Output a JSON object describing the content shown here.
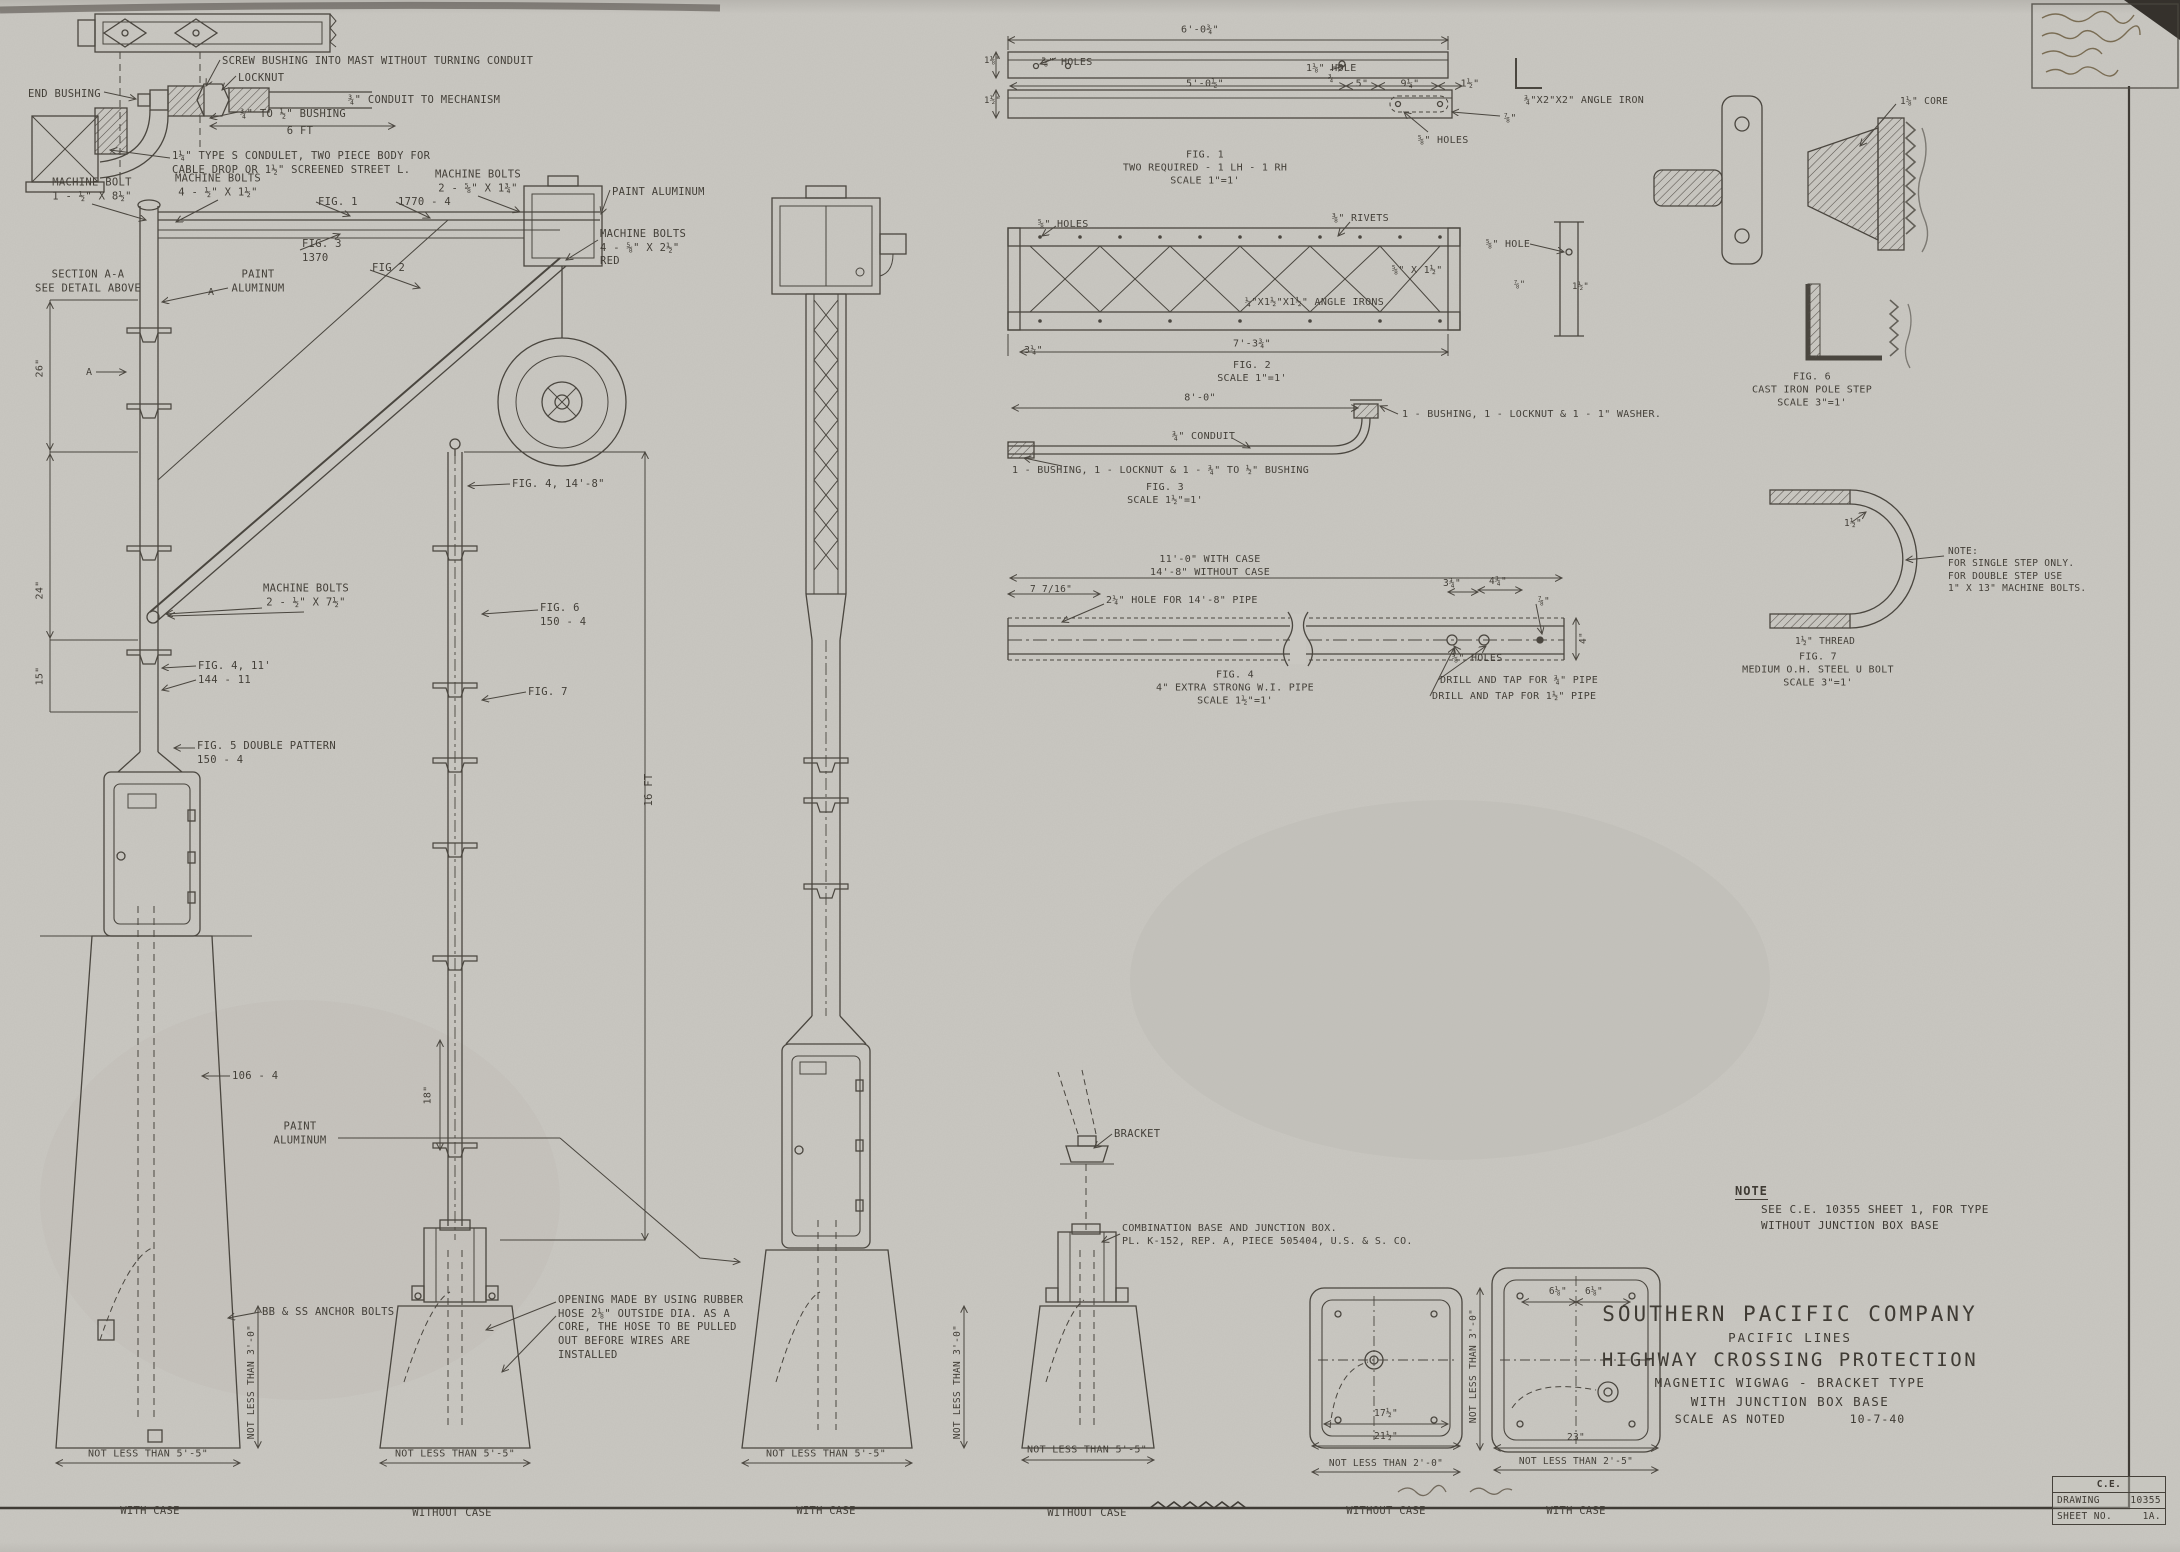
{
  "colors": {
    "paper": "#c9c7c1",
    "ink": "#4a463f"
  },
  "title_block": {
    "company": "SOUTHERN PACIFIC COMPANY",
    "division": "PACIFIC LINES",
    "title": "HIGHWAY CROSSING PROTECTION",
    "subtitle": "MAGNETIC WIGWAG - BRACKET TYPE",
    "base_type": "WITH JUNCTION BOX BASE",
    "scale": "SCALE AS NOTED",
    "date": "10-7-40"
  },
  "doc_box": {
    "org": "C.E.",
    "drawing_label": "DRAWING",
    "drawing_number": "10355",
    "sheet_label": "SHEET NO.",
    "sheet_number": "1A."
  },
  "note": {
    "heading": "NOTE",
    "line1": "SEE C.E. 10355 SHEET 1, FOR TYPE",
    "line2": "WITHOUT JUNCTION BOX BASE"
  },
  "labels": [
    {
      "name": "label-screw-bushing",
      "text": "SCREW BUSHING INTO MAST WITHOUT TURNING CONDUIT",
      "x": 222,
      "y": 55
    },
    {
      "name": "label-end-bushing",
      "text": "END BUSHING",
      "x": 28,
      "y": 88
    },
    {
      "name": "label-locknut",
      "text": "LOCKNUT",
      "x": 238,
      "y": 72
    },
    {
      "name": "label-conduit-to-mechanism",
      "text": "¾\" CONDUIT TO MECHANISM",
      "x": 348,
      "y": 94
    },
    {
      "name": "label-bushing-size",
      "text": "¾\" TO ½\" BUSHING",
      "x": 240,
      "y": 108
    },
    {
      "name": "label-dim-6ft",
      "text": "6 FT",
      "x": 300,
      "y": 132,
      "align": "center"
    },
    {
      "name": "label-condulet",
      "text": "1¼\" TYPE S CONDULET, TWO PIECE BODY FOR\nCABLE DROP OR 1½\" SCREENED STREET L.",
      "x": 172,
      "y": 150
    },
    {
      "name": "label-machine-bolt-8",
      "text": "MACHINE BOLT\n1 - ½\" X 8½\"",
      "x": 92,
      "y": 190,
      "align": "center"
    },
    {
      "name": "label-machine-bolts-4",
      "text": "MACHINE BOLTS\n4 - ½\" X 1½\"",
      "x": 218,
      "y": 186,
      "align": "center"
    },
    {
      "name": "label-machine-bolts-2",
      "text": "MACHINE BOLTS\n2 - ⅝\" X 1¾\"",
      "x": 478,
      "y": 182,
      "align": "center"
    },
    {
      "name": "label-paint-aluminum-arm",
      "text": "PAINT ALUMINUM",
      "x": 612,
      "y": 186
    },
    {
      "name": "label-fig1-ref",
      "text": "FIG. 1",
      "x": 318,
      "y": 196
    },
    {
      "name": "label-1770-4",
      "text": "1770 - 4",
      "x": 398,
      "y": 196
    },
    {
      "name": "label-machine-bolts-red",
      "text": "MACHINE BOLTS\n4 - ⅝\" X 2½\"\nRED",
      "x": 600,
      "y": 228
    },
    {
      "name": "label-fig3-ref",
      "text": "FIG. 3\n1370",
      "x": 302,
      "y": 238
    },
    {
      "name": "label-fig2-ref",
      "text": "FIG 2",
      "x": 372,
      "y": 262
    },
    {
      "name": "label-section-aa",
      "text": "SECTION A-A\nSEE DETAIL ABOVE",
      "x": 88,
      "y": 282,
      "align": "center"
    },
    {
      "name": "label-a-marker-1",
      "text": "A",
      "x": 86,
      "y": 366,
      "size": 10
    },
    {
      "name": "label-a-marker-2",
      "text": "A",
      "x": 208,
      "y": 286,
      "size": 10
    },
    {
      "name": "label-paint-aluminum-mast",
      "text": "PAINT\nALUMINUM",
      "x": 258,
      "y": 282,
      "align": "center"
    },
    {
      "name": "label-dim-26",
      "text": "26\"",
      "x": 40,
      "y": 368,
      "size": 10,
      "align": "center",
      "rot": -90
    },
    {
      "name": "label-dim-24",
      "text": "24\"",
      "x": 40,
      "y": 590,
      "size": 10,
      "align": "center",
      "rot": -90
    },
    {
      "name": "label-dim-15",
      "text": "15\"",
      "x": 40,
      "y": 676,
      "size": 10,
      "align": "center",
      "rot": -90
    },
    {
      "name": "label-machine-bolts-7",
      "text": "MACHINE BOLTS\n2 - ½\" X 7½\"",
      "x": 306,
      "y": 596,
      "align": "center"
    },
    {
      "name": "label-fig4-11",
      "text": "FIG. 4, 11'\n144 - 11",
      "x": 198,
      "y": 660
    },
    {
      "name": "label-fig4-148",
      "text": "FIG. 4, 14'-8\"",
      "x": 512,
      "y": 478
    },
    {
      "name": "label-fig5-double",
      "text": "FIG. 5 DOUBLE PATTERN\n150 - 4",
      "x": 197,
      "y": 740
    },
    {
      "name": "label-fig6-ref",
      "text": "FIG. 6\n150 - 4",
      "x": 540,
      "y": 602
    },
    {
      "name": "label-fig7-ref",
      "text": "FIG. 7",
      "x": 528,
      "y": 686
    },
    {
      "name": "label-dim-16ft",
      "text": "16 FT",
      "x": 650,
      "y": 790,
      "align": "center",
      "rot": -90
    },
    {
      "name": "label-106-4",
      "text": "106 - 4",
      "x": 232,
      "y": 1070
    },
    {
      "name": "label-paint-aluminum-case",
      "text": "PAINT\nALUMINUM",
      "x": 300,
      "y": 1134,
      "align": "center"
    },
    {
      "name": "label-dim-18",
      "text": "18\"",
      "x": 428,
      "y": 1095,
      "size": 10,
      "align": "center",
      "rot": -90
    },
    {
      "name": "label-anchor-bolts",
      "text": "BB & SS ANCHOR BOLTS",
      "x": 262,
      "y": 1306
    },
    {
      "name": "label-hose-note",
      "text": "OPENING MADE BY USING RUBBER\nHOSE 2⅛\" OUTSIDE DIA. AS A\nCORE, THE HOSE TO BE PULLED\nOUT BEFORE WIRES ARE\nINSTALLED",
      "x": 558,
      "y": 1294
    },
    {
      "name": "label-bracket",
      "text": "BRACKET",
      "x": 1114,
      "y": 1128
    },
    {
      "name": "label-combination-base",
      "text": "COMBINATION BASE AND JUNCTION BOX.\nPL. K-152, REP. A, PIECE 505404, U.S. & S. CO.",
      "x": 1122,
      "y": 1222,
      "size": 10
    },
    {
      "name": "label-nlt-1",
      "text": "NOT LESS THAN 5'-5\"",
      "x": 148,
      "y": 1454,
      "size": 10,
      "align": "center"
    },
    {
      "name": "label-nlt-2",
      "text": "NOT LESS THAN 5'-5\"",
      "x": 455,
      "y": 1454,
      "size": 10,
      "align": "center"
    },
    {
      "name": "label-nlt-3",
      "text": "NOT LESS THAN 5'-5\"",
      "x": 826,
      "y": 1454,
      "size": 10,
      "align": "center"
    },
    {
      "name": "label-nlt-4",
      "text": "NOT LESS THAN 5'-5\"",
      "x": 1087,
      "y": 1450,
      "size": 10,
      "align": "center"
    },
    {
      "name": "label-with-case-1",
      "text": "WITH CASE",
      "x": 150,
      "y": 1512,
      "align": "center"
    },
    {
      "name": "label-without-case-1",
      "text": "WITHOUT CASE",
      "x": 452,
      "y": 1514,
      "align": "center"
    },
    {
      "name": "label-with-case-2",
      "text": "WITH CASE",
      "x": 826,
      "y": 1512,
      "align": "center"
    },
    {
      "name": "label-without-case-2",
      "text": "WITHOUT CASE",
      "x": 1087,
      "y": 1514,
      "align": "center"
    },
    {
      "name": "label-without-case-3",
      "text": "WITHOUT CASE",
      "x": 1386,
      "y": 1512,
      "align": "center"
    },
    {
      "name": "label-with-case-3",
      "text": "WITH CASE",
      "x": 1576,
      "y": 1512,
      "align": "center"
    },
    {
      "name": "label-nlt-depth-1",
      "text": "NOT LESS THAN 3'-0\"",
      "x": 252,
      "y": 1382,
      "size": 9.5,
      "align": "center",
      "rot": -90
    },
    {
      "name": "label-nlt-depth-2",
      "text": "NOT LESS THAN 3'-0\"",
      "x": 958,
      "y": 1382,
      "size": 9.5,
      "align": "center",
      "rot": -90
    },
    {
      "name": "label-nlt-depth-3",
      "text": "NOT LESS THAN 3'-0\"",
      "x": 1474,
      "y": 1366,
      "size": 9.5,
      "align": "center",
      "rot": -90
    },
    {
      "name": "fig1-holes-left",
      "text": "⅝\" HOLES",
      "x": 1042,
      "y": 56,
      "size": 10
    },
    {
      "name": "fig1-dim-length",
      "text": "6'-0¾\"",
      "x": 1200,
      "y": 30,
      "size": 10,
      "align": "center"
    },
    {
      "name": "fig1-hole",
      "text": "1⅛\" HOLE",
      "x": 1306,
      "y": 62,
      "size": 10
    },
    {
      "name": "fig1-dim-34",
      "text": "¾",
      "x": 1328,
      "y": 74,
      "size": 9
    },
    {
      "name": "fig1-dim-left1",
      "text": "1⅛\"",
      "x": 984,
      "y": 56,
      "size": 9
    },
    {
      "name": "fig1-dim-left2",
      "text": "1½\"",
      "x": 984,
      "y": 96,
      "size": 9
    },
    {
      "name": "fig1-dim-5012",
      "text": "5'-0½\"",
      "x": 1205,
      "y": 84,
      "size": 10,
      "align": "center"
    },
    {
      "name": "fig1-dim-5",
      "text": "5\"",
      "x": 1362,
      "y": 84,
      "size": 10,
      "align": "center"
    },
    {
      "name": "fig1-dim-914",
      "text": "9¼\"",
      "x": 1410,
      "y": 84,
      "size": 10,
      "align": "center"
    },
    {
      "name": "fig1-dim-112",
      "text": "1½\"",
      "x": 1470,
      "y": 84,
      "size": 10,
      "align": "center"
    },
    {
      "name": "fig1-dim-78",
      "text": "⅞\"",
      "x": 1504,
      "y": 112,
      "size": 10
    },
    {
      "name": "fig1-holes-right",
      "text": "⅝\" HOLES",
      "x": 1418,
      "y": 134,
      "size": 10
    },
    {
      "name": "fig1-angle-iron",
      "text": "¾\"X2\"X2\" ANGLE IRON",
      "x": 1524,
      "y": 94,
      "size": 10
    },
    {
      "name": "fig1-caption",
      "text": "FIG. 1\nTWO REQUIRED - 1 LH - 1 RH\nSCALE 1\"=1'",
      "x": 1205,
      "y": 168,
      "size": 10,
      "align": "center"
    },
    {
      "name": "fig2-holes",
      "text": "⅝\" HOLES",
      "x": 1038,
      "y": 218,
      "size": 10
    },
    {
      "name": "fig2-rivets",
      "text": "⅜\" RIVETS",
      "x": 1332,
      "y": 212,
      "size": 10
    },
    {
      "name": "fig2-bar",
      "text": "⅝\" X 1½\"",
      "x": 1392,
      "y": 264,
      "size": 10
    },
    {
      "name": "fig2-hole",
      "text": "⅝\" HOLE",
      "x": 1486,
      "y": 238,
      "size": 10
    },
    {
      "name": "fig2-dim-78",
      "text": "⅞\"",
      "x": 1514,
      "y": 280,
      "size": 9
    },
    {
      "name": "fig2-dim-right-112",
      "text": "1½\"",
      "x": 1572,
      "y": 282,
      "size": 9
    },
    {
      "name": "fig2-angle-irons",
      "text": "¼\"X1½\"X1½\" ANGLE IRONS",
      "x": 1245,
      "y": 296,
      "size": 10
    },
    {
      "name": "fig2-dim-314",
      "text": "3¼\"",
      "x": 1024,
      "y": 344,
      "size": 10
    },
    {
      "name": "fig2-dim-length",
      "text": "7'-3¾\"",
      "x": 1252,
      "y": 344,
      "size": 10,
      "align": "center"
    },
    {
      "name": "fig2-caption",
      "text": "FIG. 2\nSCALE 1\"=1'",
      "x": 1252,
      "y": 372,
      "size": 10,
      "align": "center"
    },
    {
      "name": "fig3-dim-length",
      "text": "8'-0\"",
      "x": 1200,
      "y": 398,
      "size": 10,
      "align": "center"
    },
    {
      "name": "fig3-fittings-right",
      "text": "1 - BUSHING, 1 - LOCKNUT & 1 - 1\" WASHER.",
      "x": 1402,
      "y": 408,
      "size": 10
    },
    {
      "name": "fig3-conduit",
      "text": "¾\" CONDUIT",
      "x": 1172,
      "y": 430,
      "size": 10
    },
    {
      "name": "fig3-fittings-left",
      "text": "1 - BUSHING, 1 - LOCKNUT & 1 - ¾\" TO ½\" BUSHING",
      "x": 1012,
      "y": 464,
      "size": 10
    },
    {
      "name": "fig3-caption",
      "text": "FIG. 3\nSCALE 1½\"=1'",
      "x": 1165,
      "y": 494,
      "size": 10,
      "align": "center"
    },
    {
      "name": "fig4-dim-case",
      "text": "11'-0\" WITH CASE\n14'-8\" WITHOUT CASE",
      "x": 1210,
      "y": 566,
      "size": 10,
      "align": "center"
    },
    {
      "name": "fig4-dim-716",
      "text": "7 7/16\"",
      "x": 1030,
      "y": 584,
      "size": 9.5
    },
    {
      "name": "fig4-hole-note",
      "text": "2¼\" HOLE FOR 14'-8\" PIPE",
      "x": 1106,
      "y": 594,
      "size": 10
    },
    {
      "name": "fig4-dim-334",
      "text": "3¾\"",
      "x": 1452,
      "y": 584,
      "size": 9.5,
      "align": "center"
    },
    {
      "name": "fig4-dim-434",
      "text": "4¾\"",
      "x": 1498,
      "y": 582,
      "size": 9.5,
      "align": "center"
    },
    {
      "name": "fig4-dim-78",
      "text": "⅞\"",
      "x": 1538,
      "y": 596,
      "size": 9.5
    },
    {
      "name": "fig4-dim-4",
      "text": "4\"",
      "x": 1584,
      "y": 638,
      "size": 9.5,
      "align": "center",
      "rot": -90
    },
    {
      "name": "fig4-holes",
      "text": "⅝\" HOLES",
      "x": 1452,
      "y": 652,
      "size": 10
    },
    {
      "name": "fig4-drill-34",
      "text": "DRILL AND TAP FOR ¾\" PIPE",
      "x": 1440,
      "y": 674,
      "size": 10
    },
    {
      "name": "fig4-drill-112",
      "text": "DRILL AND TAP FOR 1½\" PIPE",
      "x": 1432,
      "y": 690,
      "size": 10
    },
    {
      "name": "fig4-caption",
      "text": "FIG. 4\n4\" EXTRA STRONG W.I. PIPE\nSCALE 1½\"=1'",
      "x": 1235,
      "y": 688,
      "size": 10,
      "align": "center"
    },
    {
      "name": "fig6-core",
      "text": "1⅛\" CORE",
      "x": 1900,
      "y": 96,
      "size": 9.5
    },
    {
      "name": "fig6-caption",
      "text": "FIG. 6\nCAST IRON POLE STEP\nSCALE 3\"=1'",
      "x": 1812,
      "y": 390,
      "size": 10,
      "align": "center"
    },
    {
      "name": "fig7-dim-112",
      "text": "1½\"",
      "x": 1844,
      "y": 518,
      "size": 9.5
    },
    {
      "name": "fig7-note",
      "text": "NOTE:\nFOR SINGLE STEP ONLY.\nFOR DOUBLE STEP USE\n1\" X 13\" MACHINE BOLTS.",
      "x": 1948,
      "y": 546,
      "size": 9.5
    },
    {
      "name": "fig7-thread",
      "text": "1½\" THREAD",
      "x": 1795,
      "y": 636,
      "size": 9.5
    },
    {
      "name": "fig7-caption",
      "text": "FIG. 7\nMEDIUM O.H. STEEL U BOLT\nSCALE 3\"=1'",
      "x": 1818,
      "y": 670,
      "size": 10,
      "align": "center"
    },
    {
      "name": "plan1-dim-1712",
      "text": "17½\"",
      "x": 1386,
      "y": 1414,
      "size": 9.5,
      "align": "center"
    },
    {
      "name": "plan1-dim-2112",
      "text": "21½\"",
      "x": 1386,
      "y": 1437,
      "size": 9.5,
      "align": "center"
    },
    {
      "name": "plan1-nlt",
      "text": "NOT LESS THAN 2'-0\"",
      "x": 1386,
      "y": 1464,
      "size": 9.5,
      "align": "center"
    },
    {
      "name": "plan2-dims-618",
      "text": "6⅛\"   6⅛\"",
      "x": 1576,
      "y": 1292,
      "size": 9.5,
      "align": "center"
    },
    {
      "name": "plan2-dim-23",
      "text": "23\"",
      "x": 1576,
      "y": 1438,
      "size": 9.5,
      "align": "center"
    },
    {
      "name": "plan2-nlt",
      "text": "NOT LESS THAN 2'-5\"",
      "x": 1576,
      "y": 1462,
      "size": 9.5,
      "align": "center"
    }
  ]
}
